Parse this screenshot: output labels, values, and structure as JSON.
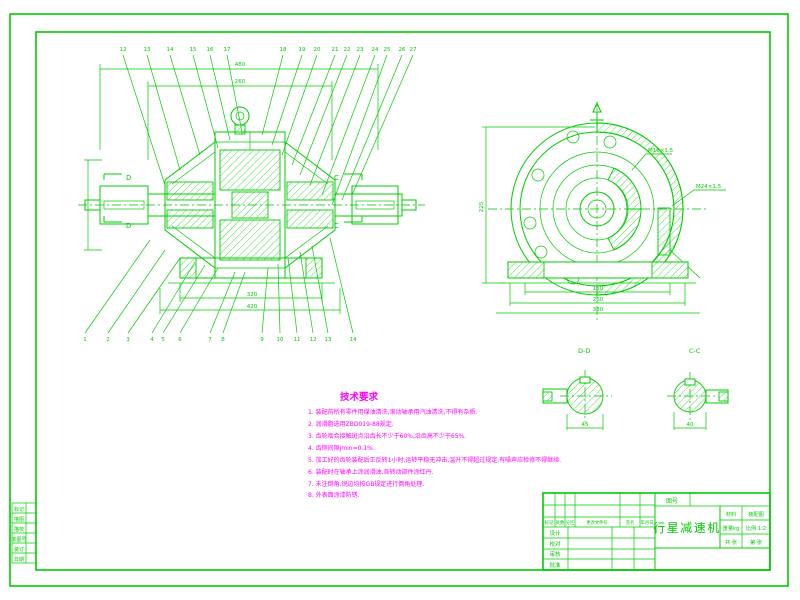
{
  "drawing": {
    "title": "行星减速机",
    "line_color": "#00cc00",
    "requirement_color": "#ff00ff",
    "background": "#ffffff"
  },
  "tech_requirements": {
    "title": "技术要求",
    "items": [
      "1. 装配前所有零件用煤油清洗,滚动轴承用汽油清洗,不得有杂质.",
      "2. 润滑脂选用ZBD019-88规定.",
      "3. 齿轮啮合接触斑点沿齿长不少于60%,沿齿高不少于65%.",
      "4. 齿侧间隙jmin=0.1%.",
      "5. 加工好的齿轮装配后正反转1小时,运转平稳无冲击,温升不得超过规定,有噪声应检修不得继续.",
      "6. 装配时在轴承上涂润滑油,各转动部件涂红丹.",
      "7. 未注倒角,锐边均按GB规定进行倒角处理.",
      "8. 外表面涂漆防锈."
    ]
  },
  "title_block": {
    "drawing_no_label": "图号",
    "part_name": "行星减速机",
    "material_label": "材料",
    "material_value": "装配图",
    "weight_label": "重量kg",
    "scale_label": "比例 1:2",
    "sheets_total": "共  张",
    "sheet_no": "第  张",
    "header": [
      "标记",
      "处数",
      "分区",
      "更改文件号",
      "签名",
      "年月日"
    ],
    "rows": [
      "设计",
      "校对",
      "审核",
      "批准"
    ]
  },
  "margin_table": {
    "rows": [
      "标记",
      "描图",
      "描校",
      "底图号",
      "装订",
      "日期"
    ]
  },
  "sections": {
    "dd_label": "D-D",
    "cc_label": "C-C",
    "d_mark": "D",
    "c_mark": "C"
  },
  "balloons": {
    "top": [
      "12",
      "13",
      "14",
      "15",
      "16",
      "17",
      "18",
      "19",
      "20",
      "21",
      "22",
      "23",
      "24",
      "25",
      "26",
      "27"
    ],
    "bottom": [
      "1",
      "2",
      "3",
      "4",
      "5",
      "6",
      "7",
      "8",
      "9",
      "10",
      "11",
      "12",
      "13",
      "14"
    ]
  },
  "dimensions": {
    "overall_length": "480",
    "inner_length": "260",
    "base_width": "320",
    "base_width2": "420",
    "dd_dim": "45",
    "cc_dim": "40",
    "front_b1": "150",
    "front_b2": "260",
    "front_b3": "330",
    "front_height": "225",
    "leader1": "M16×1.5",
    "leader2": "M24×1.5"
  }
}
